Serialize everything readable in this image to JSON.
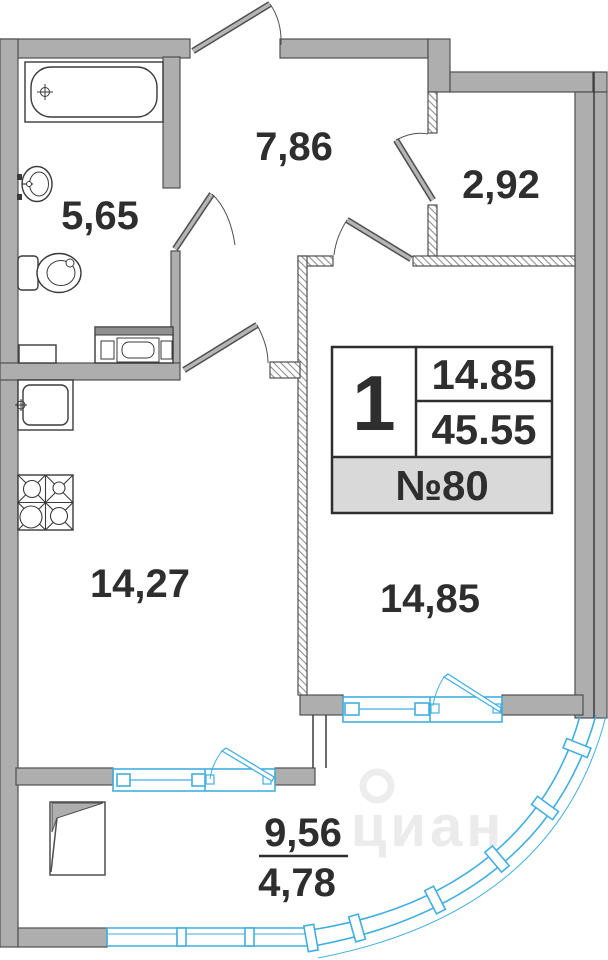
{
  "plan": {
    "watermark": "циан",
    "rooms": {
      "bathroom": "5,65",
      "hallway": "7,86",
      "wardrobe": "2,92",
      "kitchen": "14,27",
      "living_room": "14,85",
      "balcony_full": "9,56",
      "balcony_reduced": "4,78"
    },
    "info_box": {
      "rooms_count": "1",
      "living_area": "14.85",
      "total_area": "45.55",
      "apartment_number": "№80"
    },
    "colors": {
      "wall_fill": "#aeaeae",
      "wall_line": "#4f4f4f",
      "glazing": "#41afe0",
      "ink": "#2e2e2e",
      "info_row_bg": "#d9d9d9"
    }
  }
}
